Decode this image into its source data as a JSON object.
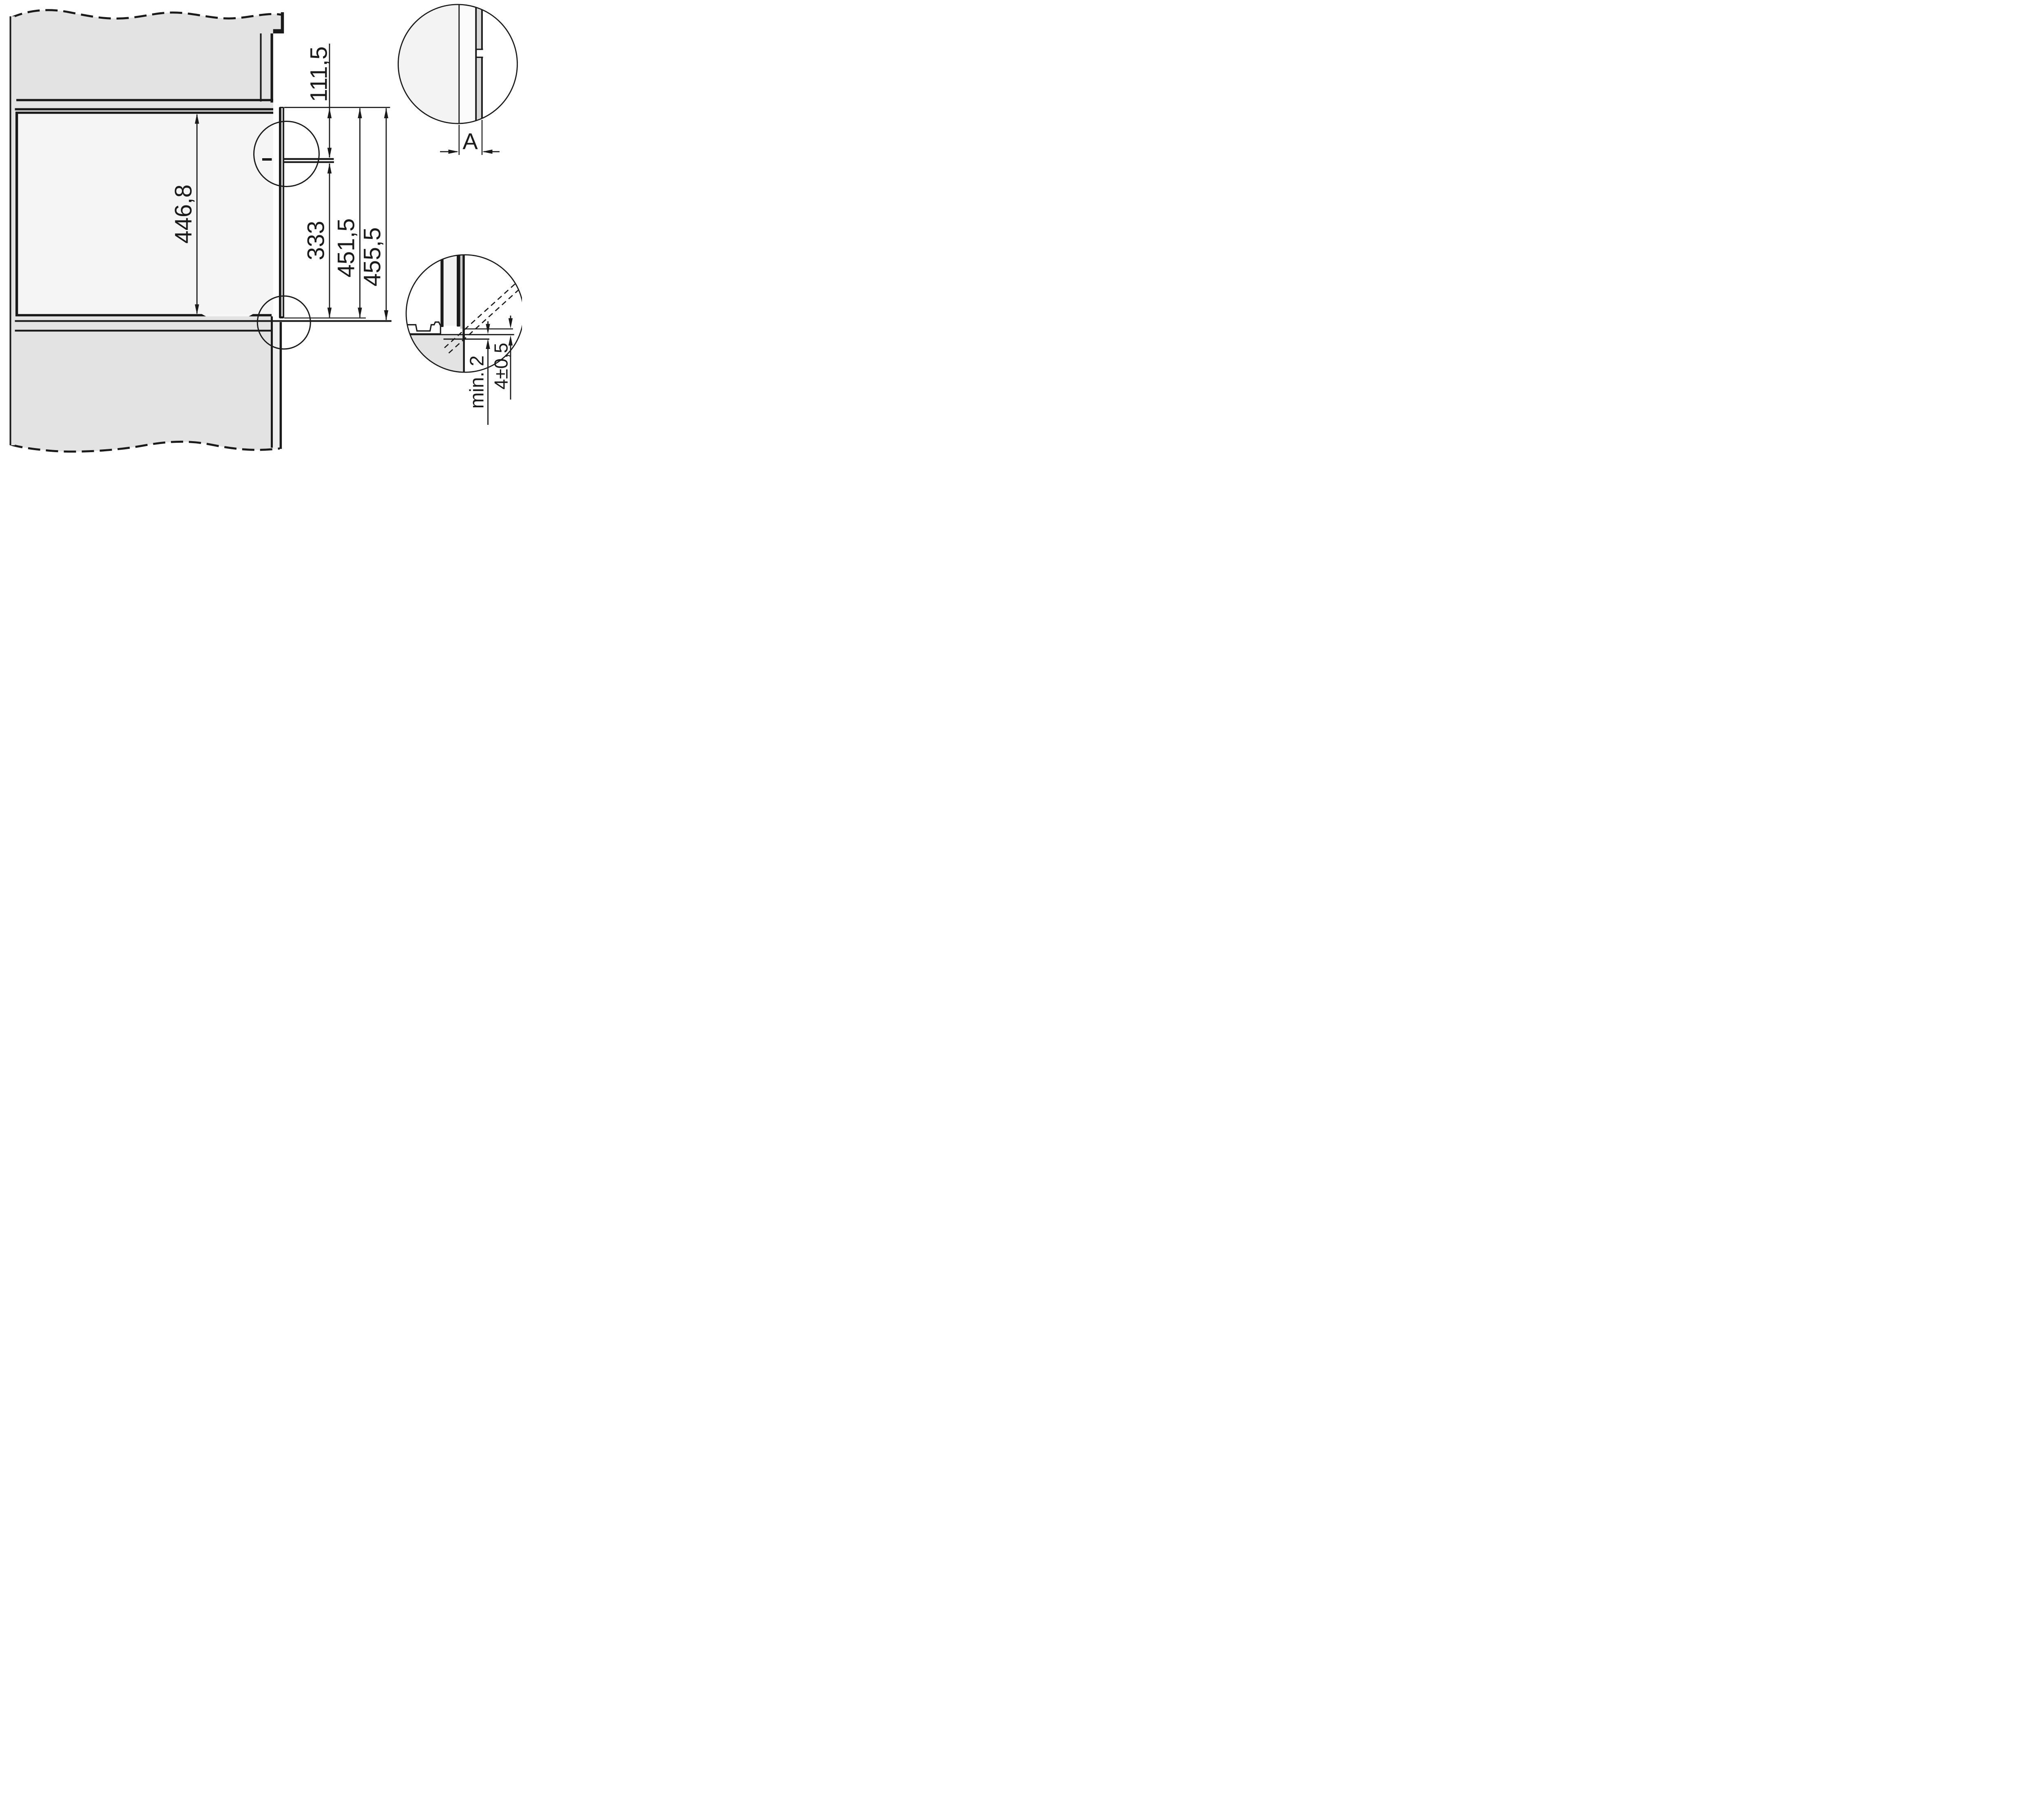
{
  "dimensions": {
    "niche_height": "446,8",
    "top_to_bracket": "111,5",
    "bracket_to_front_bottom": "333",
    "front_frame_height": "451,5",
    "overall_front_height": "455,5",
    "gap_detail_label": "A",
    "min_clearance": "min. 2",
    "reveal_tolerance": "4±0,5"
  },
  "colors": {
    "line": "#1a1a1a",
    "cabinet_fill": "#e3e3e3",
    "niche_fill": "#f5f5f5",
    "panel_light_fill": "#eeeeee",
    "gap_light_fill": "#efefef",
    "frame_core_fill": "#d6d6d6",
    "detail_left_fill": "#f3f3f3",
    "detail_mid_fill": "#fbfbfb",
    "detail_strip_fill": "#d7d7d7",
    "detail_trim_fill": "#c9c9c9",
    "background": "#ffffff"
  }
}
